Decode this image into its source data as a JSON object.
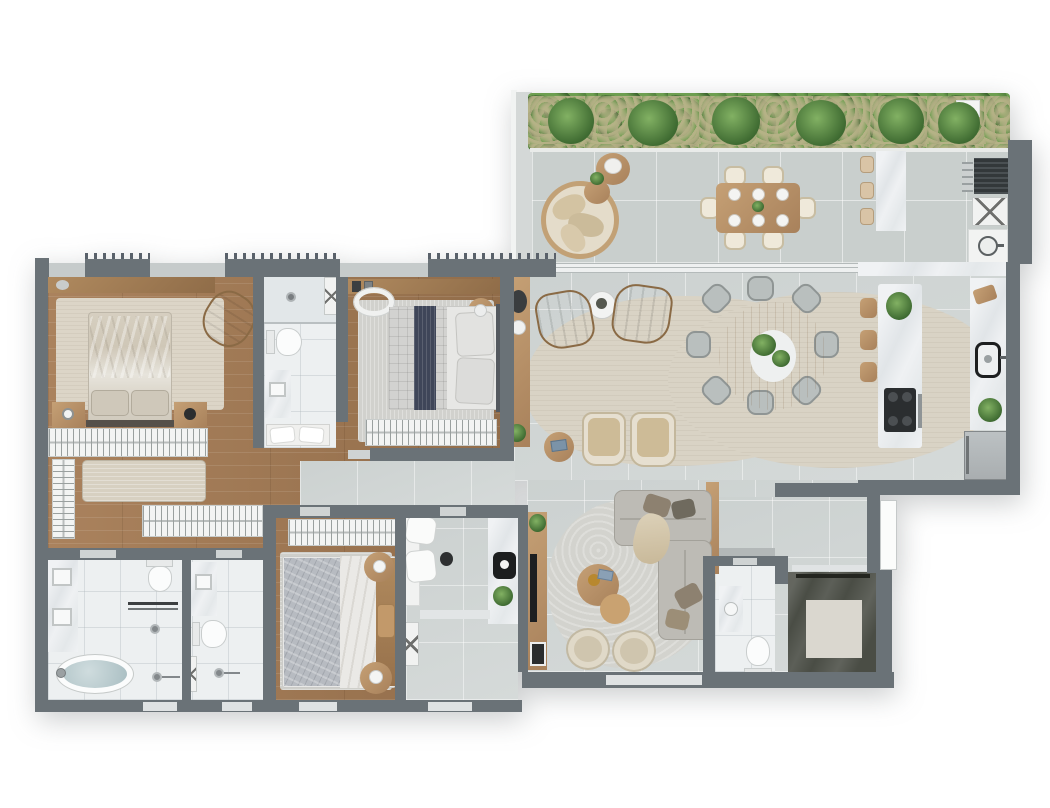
{
  "scene": {
    "kind": "apartment-floor-plan-3d-render",
    "view": "top-down",
    "background": "#ffffff",
    "no_visible_text": true
  },
  "palette": {
    "wall_dark": "#6a7277",
    "wall_light": "#c6cbcb",
    "wood_floor": "#a17a55",
    "living_tile": "#d3d8d7",
    "terrace_tile": "#c9cfcd",
    "bath_tile": "#edf0f1",
    "marble": "#eaedef",
    "hedge_green": "#47703a",
    "hedge_light": "#79a85c",
    "rug_beige": "#d9d3c5",
    "rug_gray": "#d1d1cc",
    "leather_tan": "#ad8a60",
    "fabric_beige": "#d8cbb2",
    "sofa_gray": "#bdbbb5",
    "navy_throw": "#3f4659",
    "elevator_stone": "#4a4d45",
    "tub_water": "#b7c9cc",
    "appliance_black": "#2e3133"
  },
  "rooms": [
    {
      "name": "terrace",
      "furniture": [
        "hedge-planter",
        "round-daybed",
        "side-tables",
        "outdoor-dining-table-six-seats",
        "bar-counter",
        "bar-stools",
        "grill",
        "folding-table",
        "outdoor-sink"
      ]
    },
    {
      "name": "living-room",
      "furniture": [
        "console-sideboard",
        "area-rug",
        "tan-armchair",
        "tan-armchair",
        "round-coffee-table",
        "beige-chair",
        "beige-chair",
        "side-table",
        "round-dining-table-eight-chairs"
      ]
    },
    {
      "name": "kitchen",
      "furniture": [
        "island-counter",
        "bar-stools",
        "cooktop",
        "wall-counter",
        "sink",
        "refrigerator"
      ]
    },
    {
      "name": "tv-room",
      "furniture": [
        "tv-console",
        "tv",
        "sectional-sofa",
        "coffee-tables",
        "swivel-chairs",
        "area-rug"
      ]
    },
    {
      "name": "hall-elevator",
      "furniture": [
        "elevator-cab",
        "entry-door"
      ]
    },
    {
      "name": "powder-room",
      "furniture": [
        "vanity-sink",
        "toilet"
      ]
    },
    {
      "name": "master-bedroom",
      "furniture": [
        "double-bed",
        "nightstands",
        "tan-armchair",
        "area-rug",
        "wardrobe-racks",
        "bench"
      ]
    },
    {
      "name": "ensuite-bathroom",
      "furniture": [
        "shower",
        "toilet",
        "vanity-sink",
        "cushion-bench"
      ]
    },
    {
      "name": "bedroom-2",
      "furniture": [
        "double-bed-navy-throw",
        "wall-shelf",
        "mirror",
        "side-table",
        "wardrobe-rack"
      ]
    },
    {
      "name": "master-bathroom",
      "furniture": [
        "double-vanity",
        "toilet",
        "towel-bar",
        "shower",
        "freestanding-tub"
      ]
    },
    {
      "name": "bathroom-2",
      "furniture": [
        "vanity-sink",
        "toilet",
        "shower",
        "shower-caddy"
      ]
    },
    {
      "name": "bedroom-3",
      "furniture": [
        "double-bed-gray-quilt",
        "round-nightstands",
        "wardrobe-rack",
        "area-rug"
      ]
    },
    {
      "name": "laundry-office",
      "furniture": [
        "desk-chairs",
        "counter",
        "black-sink",
        "plant",
        "drying-stool"
      ]
    }
  ]
}
